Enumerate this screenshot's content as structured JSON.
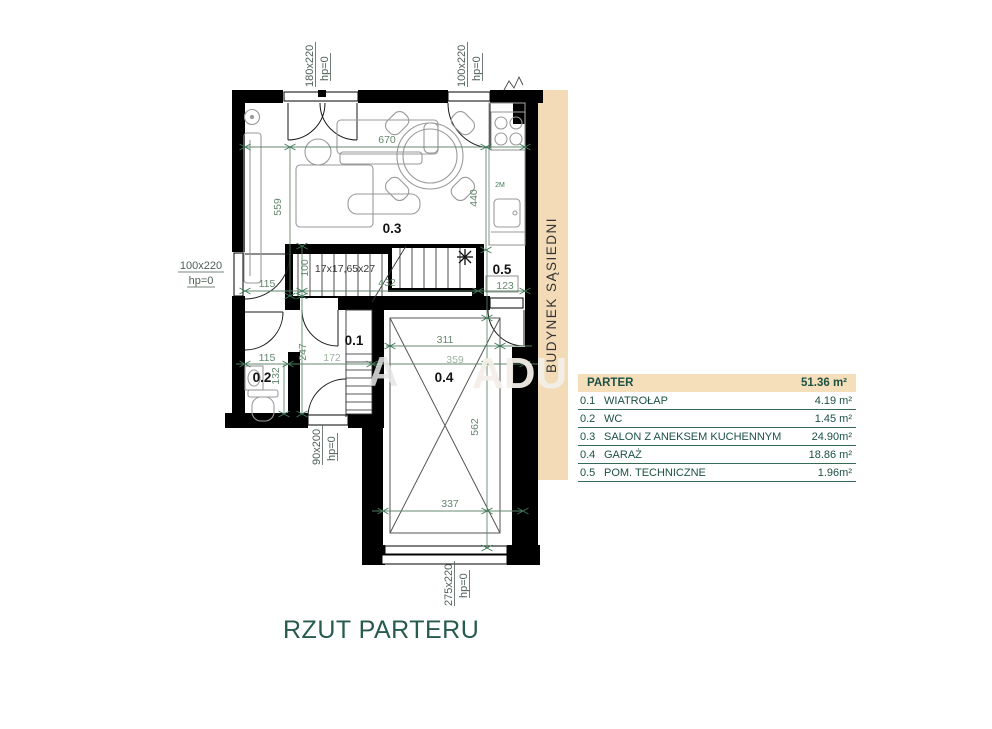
{
  "title": "RZUT PARTERU",
  "neighbor_building_label": "BUDYNEK SĄSIEDNI",
  "watermark_fragments": {
    "left": "A",
    "right": "ADU"
  },
  "legend": {
    "header": {
      "name": "PARTER",
      "area": "51.36 m²"
    },
    "rows": [
      {
        "id": "0.1",
        "name": "WIATROŁAP",
        "area": "4.19 m²"
      },
      {
        "id": "0.2",
        "name": "WC",
        "area": "1.45 m²"
      },
      {
        "id": "0.3",
        "name": "SALON Z ANEKSEM KUCHENNYM",
        "area": "24.90m²"
      },
      {
        "id": "0.4",
        "name": "GARAŻ",
        "area": "18.86 m²"
      },
      {
        "id": "0.5",
        "name": "POM. TECHNICZNE",
        "area": "1.96m²"
      }
    ]
  },
  "plan": {
    "room_labels": {
      "hall": "0.1",
      "wc": "0.2",
      "salon": "0.3",
      "garage": "0.4",
      "tech": "0.5"
    },
    "stairs_spec": "17x17,65x27",
    "kitchen_mark": "2M",
    "openings": {
      "entry_door": {
        "size": "180x220",
        "hp": "hp=0"
      },
      "terrace_door": {
        "size": "100x220",
        "hp": "hp=0"
      },
      "side_door": {
        "size": "100x220",
        "hp": "hp=0"
      },
      "back_door": {
        "size": "90x200",
        "hp": "hp=0"
      },
      "garage_gate": {
        "size": "275x220",
        "hp": "hp=0"
      }
    },
    "dims": {
      "d670": "670",
      "d440": "440",
      "d559": "559",
      "d115_top": "115",
      "d100": "100",
      "d432": "432",
      "d123": "123",
      "d115_low": "115",
      "d132": "132",
      "d247": "247",
      "d172": "172",
      "d311": "311",
      "d359": "359",
      "d562": "562",
      "d337": "337"
    }
  }
}
